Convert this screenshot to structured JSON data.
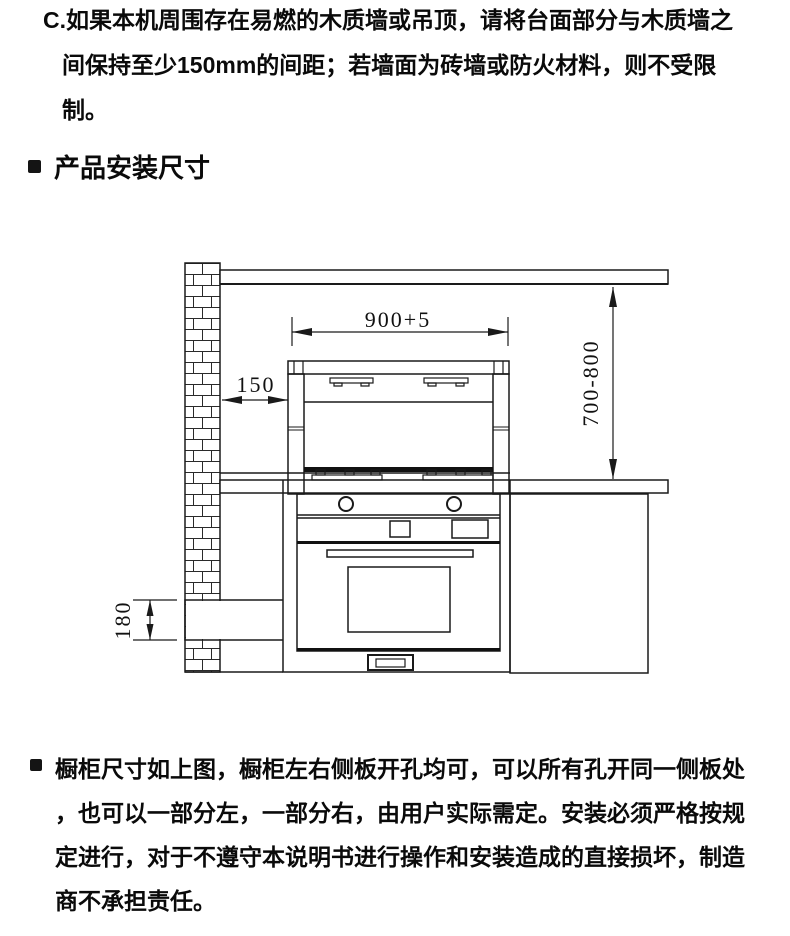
{
  "intro_paragraph": {
    "lines": [
      "C.如果本机周围存在易燃的木质墙或吊顶，请将台面部分与木质墙之",
      "间保持至少150mm的间距；若墙面为砖墙或防火材料，则不受限",
      "制。"
    ]
  },
  "section_heading": {
    "label": "产品安装尺寸"
  },
  "diagram": {
    "dimensions": {
      "width": "900+5",
      "wall_gap": "150",
      "height_range": "700-800",
      "base_height": "180"
    },
    "line_color": "#1a1a1a"
  },
  "footer_paragraph": {
    "lines": [
      "橱柜尺寸如上图，橱柜左右侧板开孔均可，可以所有孔开同一侧板处",
      "，也可以一部分左，一部分右，由用户实际需定。安装必须严格按规",
      "定进行，对于不遵守本说明书进行操作和安装造成的直接损坏，制造",
      "商不承担责任。"
    ]
  }
}
